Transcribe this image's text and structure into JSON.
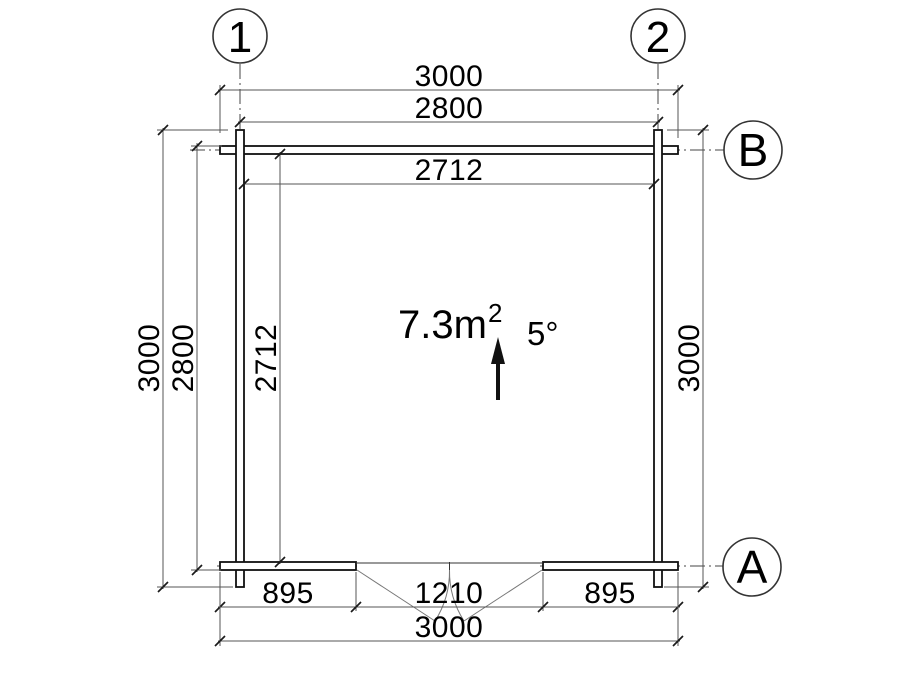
{
  "plan": {
    "grid": {
      "column_1": "1",
      "column_2": "2",
      "row_b": "B",
      "row_a": "A"
    },
    "dimensions": {
      "top_overall": "3000",
      "top_outer_width": "2800",
      "top_interior_width": "2712",
      "left_overall": "3000",
      "left_outer_depth": "2800",
      "left_interior_depth": "2712",
      "right_overall": "3000",
      "bottom_left_segment": "895",
      "bottom_door_opening": "1210",
      "bottom_right_segment": "895",
      "bottom_overall": "3000"
    },
    "annotations": {
      "floor_area_value": "7.3m",
      "floor_area_exponent": "2",
      "roof_pitch_angle": "5°"
    },
    "colors": {
      "wall_line": "#111111",
      "dimension_line": "#555555",
      "text": "#000000",
      "background": "#ffffff"
    }
  }
}
